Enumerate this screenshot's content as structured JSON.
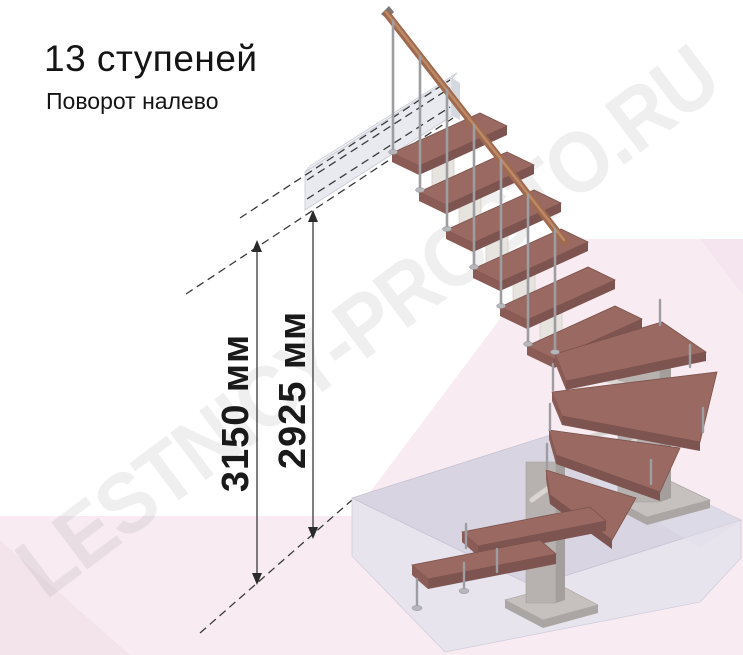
{
  "header": {
    "title": "13 ступеней",
    "subtitle": "Поворот налево"
  },
  "dimensions": {
    "total_height": "3150 мм",
    "to_platform": "2925 мм"
  },
  "watermark": "LESTNICY-PROSTO.RU",
  "stair_info": {
    "steps_visible": "13",
    "turn_direction_label": "Поворот налево"
  },
  "colors": {
    "tread": "#9a6a62",
    "handrail": "#a06a4e",
    "metal": "#9d9da2",
    "floor_platform_top": "#d8d4e2",
    "floor_platform_front": "#e7e4ee",
    "upper_landing": "#e9eaf0",
    "background_pink": "#f8ecf2",
    "dimension_text": "#1a1a1a"
  }
}
